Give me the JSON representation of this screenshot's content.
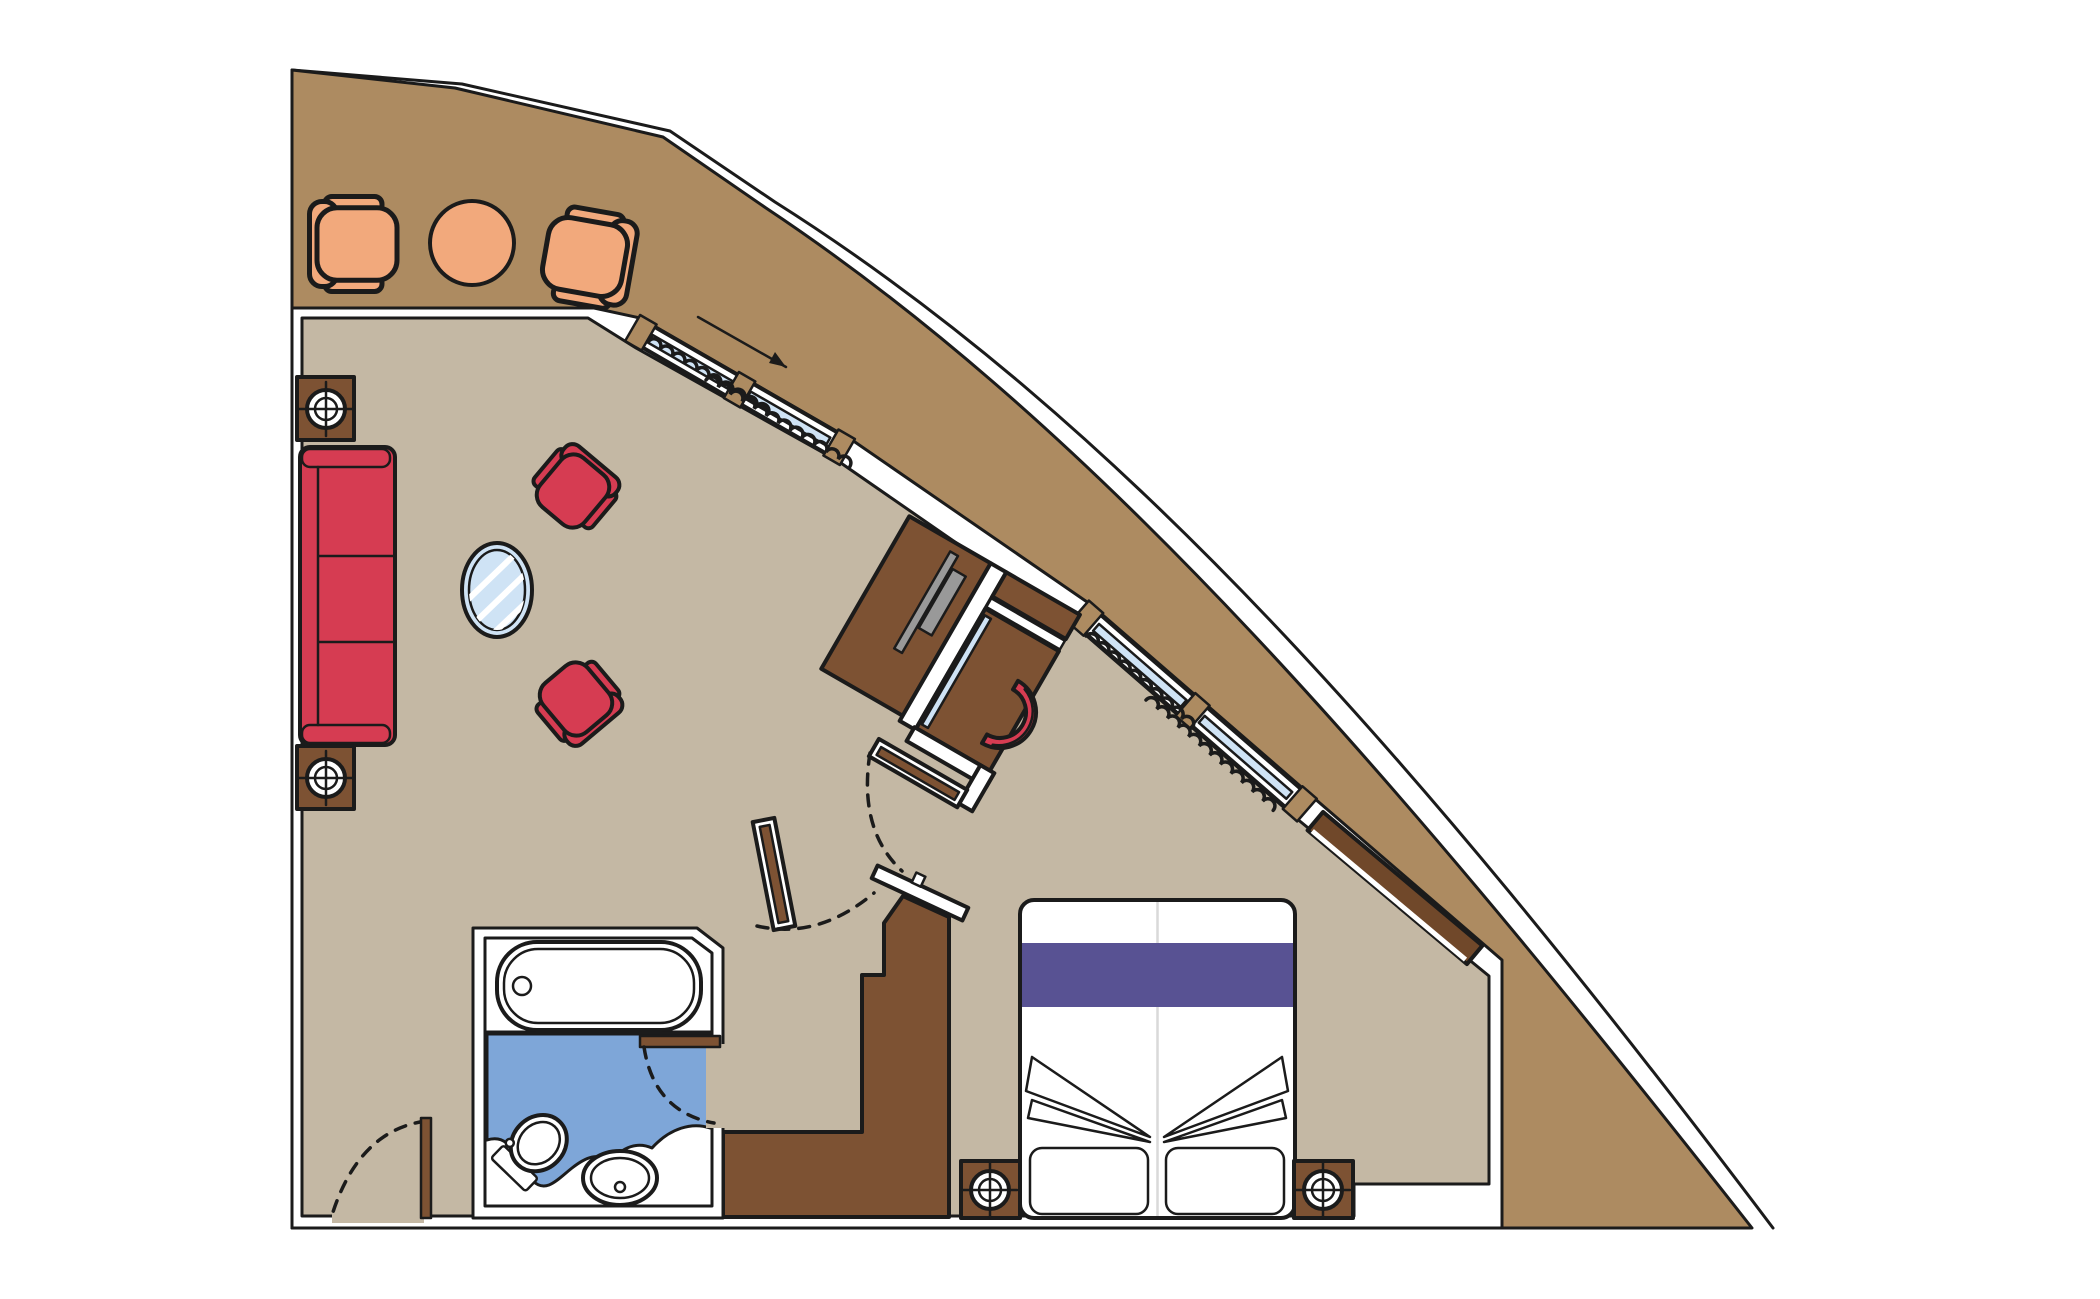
{
  "document": {
    "type": "floor-plan",
    "subject": "cruise-ship-suite-with-wrap-around-balcony",
    "orientation": "top-down"
  },
  "colors": {
    "background": "#ffffff",
    "outline": "#1b1b1b",
    "deck": "#ad8b61",
    "floor": "#c4b8a4",
    "wall": "#ffffff",
    "wood": "#7d5233",
    "wood_dark": "#70482a",
    "chair_orange": "#f2a97c",
    "upholstery_red": "#d63c52",
    "runner_purple": "#585293",
    "bath_blue": "#7ea6d8",
    "glass_blue": "#cfe3f5",
    "tv_gray": "#999999",
    "linen": "#ffffff",
    "bed_seam": "#d9d9d9"
  },
  "balcony": {
    "furniture": [
      "tub-chair",
      "round-table",
      "tub-chair"
    ]
  },
  "living_area": {
    "furniture": [
      "three-seat-sofa",
      "side-table-with-lamp",
      "side-table-with-lamp",
      "armchair",
      "armchair",
      "oval-glass-table"
    ]
  },
  "bedroom": {
    "furniture": [
      "double-bed",
      "pillow",
      "pillow",
      "bed-runner",
      "nightstand-with-lamp",
      "nightstand-with-lamp",
      "tv-cabinet",
      "tv",
      "vanity-desk",
      "vanity-mirror",
      "stool",
      "wardrobe",
      "wall-console"
    ]
  },
  "bathroom": {
    "fixtures": [
      "bathtub",
      "toilet",
      "washbasin",
      "vanity-counter"
    ]
  },
  "openings": {
    "doors": [
      "entrance-door",
      "bathroom-door",
      "bedroom-door",
      "hall-door"
    ],
    "windows": [
      "sliding-glass-door",
      "sliding-glass-door"
    ],
    "annotations": [
      "slide-direction-arrow",
      "door-swing-arc",
      "curtain-squiggle"
    ]
  }
}
